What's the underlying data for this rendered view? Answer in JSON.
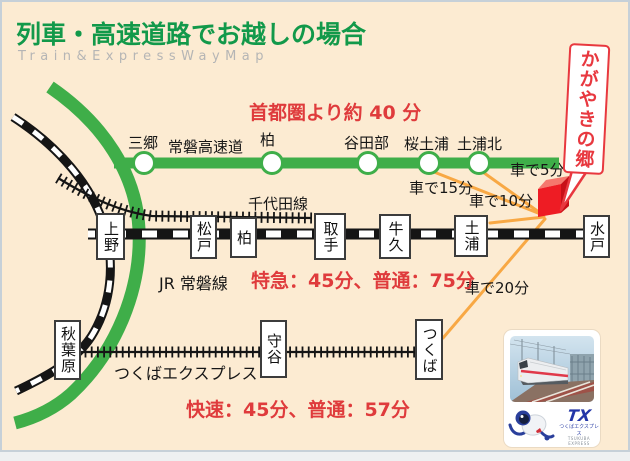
{
  "title": "列車・高速道路でお越しの場合",
  "subtitle": "Train&ExpressWayMap",
  "expressway": {
    "note": "首都圏より約 40 分",
    "line_label": "常磐高速道",
    "stations": [
      "三郷",
      "柏",
      "谷田部",
      "桜土浦",
      "土浦北"
    ]
  },
  "jr": {
    "line_label": "JR 常磐線",
    "time_note": "特急：45分、普通：75分",
    "branch_label": "千代田線",
    "stations": [
      "上野",
      "松戸",
      "柏",
      "取手",
      "牛久",
      "土浦",
      "水戸"
    ]
  },
  "tx": {
    "line_label": "つくばエクスプレス",
    "time_note": "快速：45分、普通：57分",
    "stations": [
      "秋葉原",
      "守谷",
      "つくば"
    ]
  },
  "drive": {
    "from_sakuradotsuchiura": "車で15分",
    "from_tsuchiura": "車で10分",
    "from_tsuchiurakita": "車で5分",
    "from_tsukuba": "車で20分"
  },
  "destination": "かがやきの郷",
  "logo": {
    "tx": "TX",
    "tx_jp": "つくばエクスプレス",
    "tx_en": "TSUKUBA EXPRESS"
  },
  "colors": {
    "background": "#fcebd2",
    "green_line": "#3fae49",
    "title_green": "#12994a",
    "red_text": "#df3b3c",
    "orange_line": "#f8a844",
    "cube_red": "#ee1c24",
    "bubble_red": "#e8383f"
  }
}
